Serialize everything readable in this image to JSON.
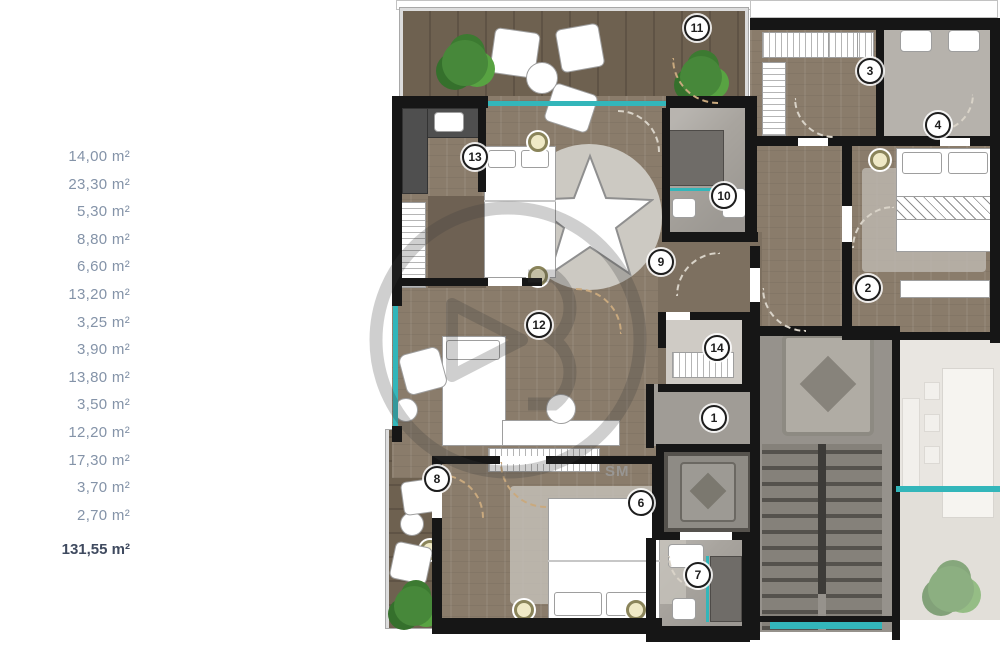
{
  "sidebar": {
    "areas": [
      "14,00 m²",
      "23,30 m²",
      "5,30 m²",
      "8,80 m²",
      "6,60 m²",
      "13,20 m²",
      "3,25 m²",
      "3,90 m²",
      "13,80 m²",
      "3,50 m²",
      "12,20 m²",
      "17,30 m²",
      "3,70 m²",
      "2,70 m²"
    ],
    "total": "131,55 m²"
  },
  "plan": {
    "markers": [
      "1",
      "2",
      "3",
      "4",
      "6",
      "7",
      "8",
      "9",
      "10",
      "11",
      "12",
      "13",
      "14"
    ],
    "sm_label": "SM",
    "colors": {
      "wall": "#161616",
      "wood_floor": "#8a7c6b",
      "terrace_deck": "#6e6150",
      "marble": "#a8a49e",
      "bathroom": "#b6b2ac",
      "window_glass": "#33b6ba",
      "plant_green": "#47883a",
      "faded_neighbor_unit": "#e9e6e1",
      "area_text": "#8493a8",
      "total_text": "#3f4a5f"
    }
  }
}
